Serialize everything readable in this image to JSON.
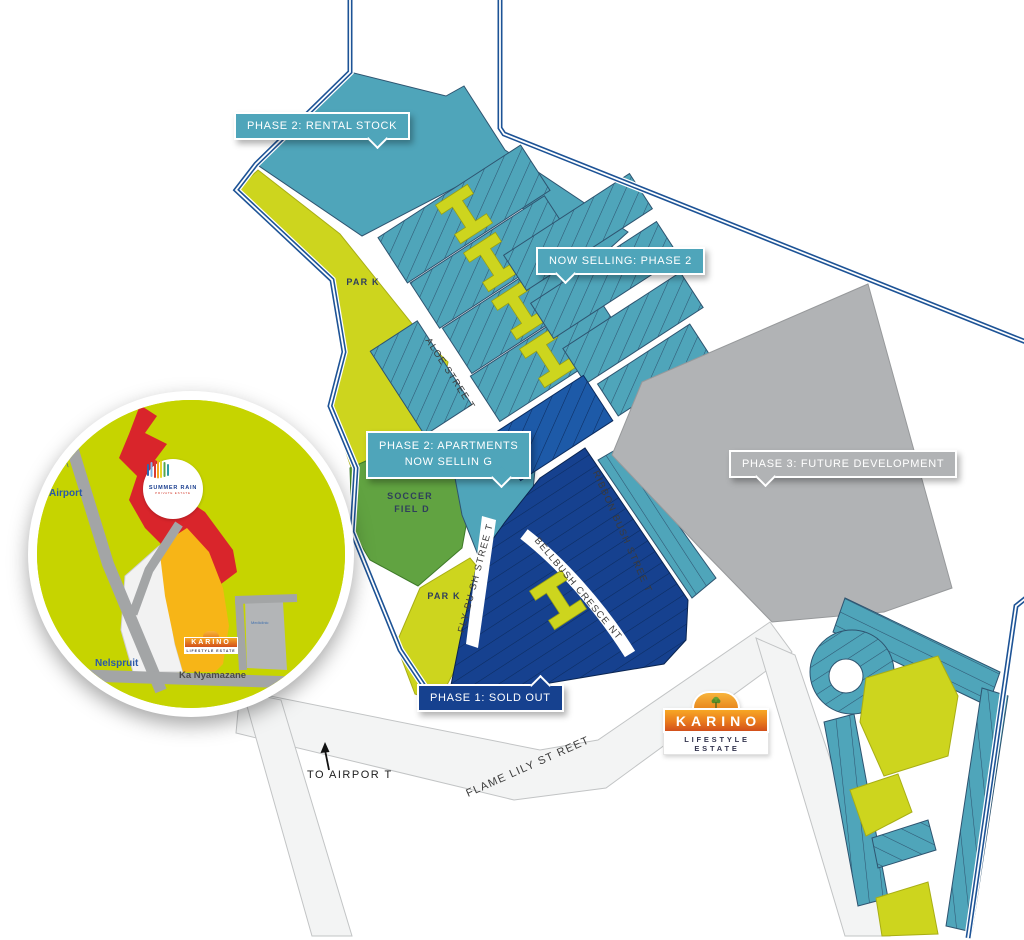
{
  "map": {
    "colors": {
      "teal": "#4FA5BA",
      "navy": "#16418F",
      "mid_blue": "#1D5AA8",
      "lime": "#CDD51E",
      "field_green": "#61A341",
      "gray": "#B1B3B5",
      "boundary_blue": "#1D5396",
      "road_fill": "#F3F4F4",
      "street_label": "#3B3B3B",
      "area_label": "#2F3E5C",
      "callout_text": "#FFFFFF"
    },
    "callouts": {
      "phase2_rental": {
        "label": "PHASE 2: RENTAL STOCK",
        "color": "#4FA5BA"
      },
      "now_selling": {
        "label": "NOW SELLING: PHASE 2",
        "color": "#4FA5BA"
      },
      "phase2_apartments": {
        "line1": "PHASE 2: APARTMENTS",
        "line2": "NOW SELLIN G",
        "color": "#4FA5BA"
      },
      "phase3": {
        "label": "PHASE 3: FUTURE DEVELOPMENT",
        "color": "#B1B3B5"
      },
      "phase1": {
        "label": "PHASE 1: SOLD OUT",
        "color": "#16418F"
      }
    },
    "streets": {
      "aloe": "ALOE STREE T",
      "fly_bush": "FLY BU SH STREE T",
      "bellbush": "BELLBUSH CRESCE NT",
      "ribbon_bush": "RIBBON BUSH STREE T",
      "flame_lily": "FLAME LILY ST REET"
    },
    "areas": {
      "park_north": "PAR K",
      "park_south": "PAR K",
      "soccer_field_line1": "SOCCER",
      "soccer_field_line2": "FIEL D"
    },
    "annotations": {
      "to_airport": "TO AIRPOR T"
    },
    "karino_logo": {
      "name": "KARINO",
      "tagline": "LIFESTYLE ESTATE"
    },
    "inset": {
      "colors": {
        "lime": "#C6D400",
        "red": "#D9252B",
        "yellow": "#F7B517",
        "road_gray": "#A3A5A6"
      },
      "summer_rain": {
        "name": "SUMMER RAIN",
        "tagline": "PRIVATE ESTATE"
      },
      "labels": {
        "airport": "Airport",
        "nelspruit": "Nelspruit",
        "ka_nyamazane": "Ka Nyamazane",
        "mediclinic": "Mediclinic"
      }
    }
  }
}
